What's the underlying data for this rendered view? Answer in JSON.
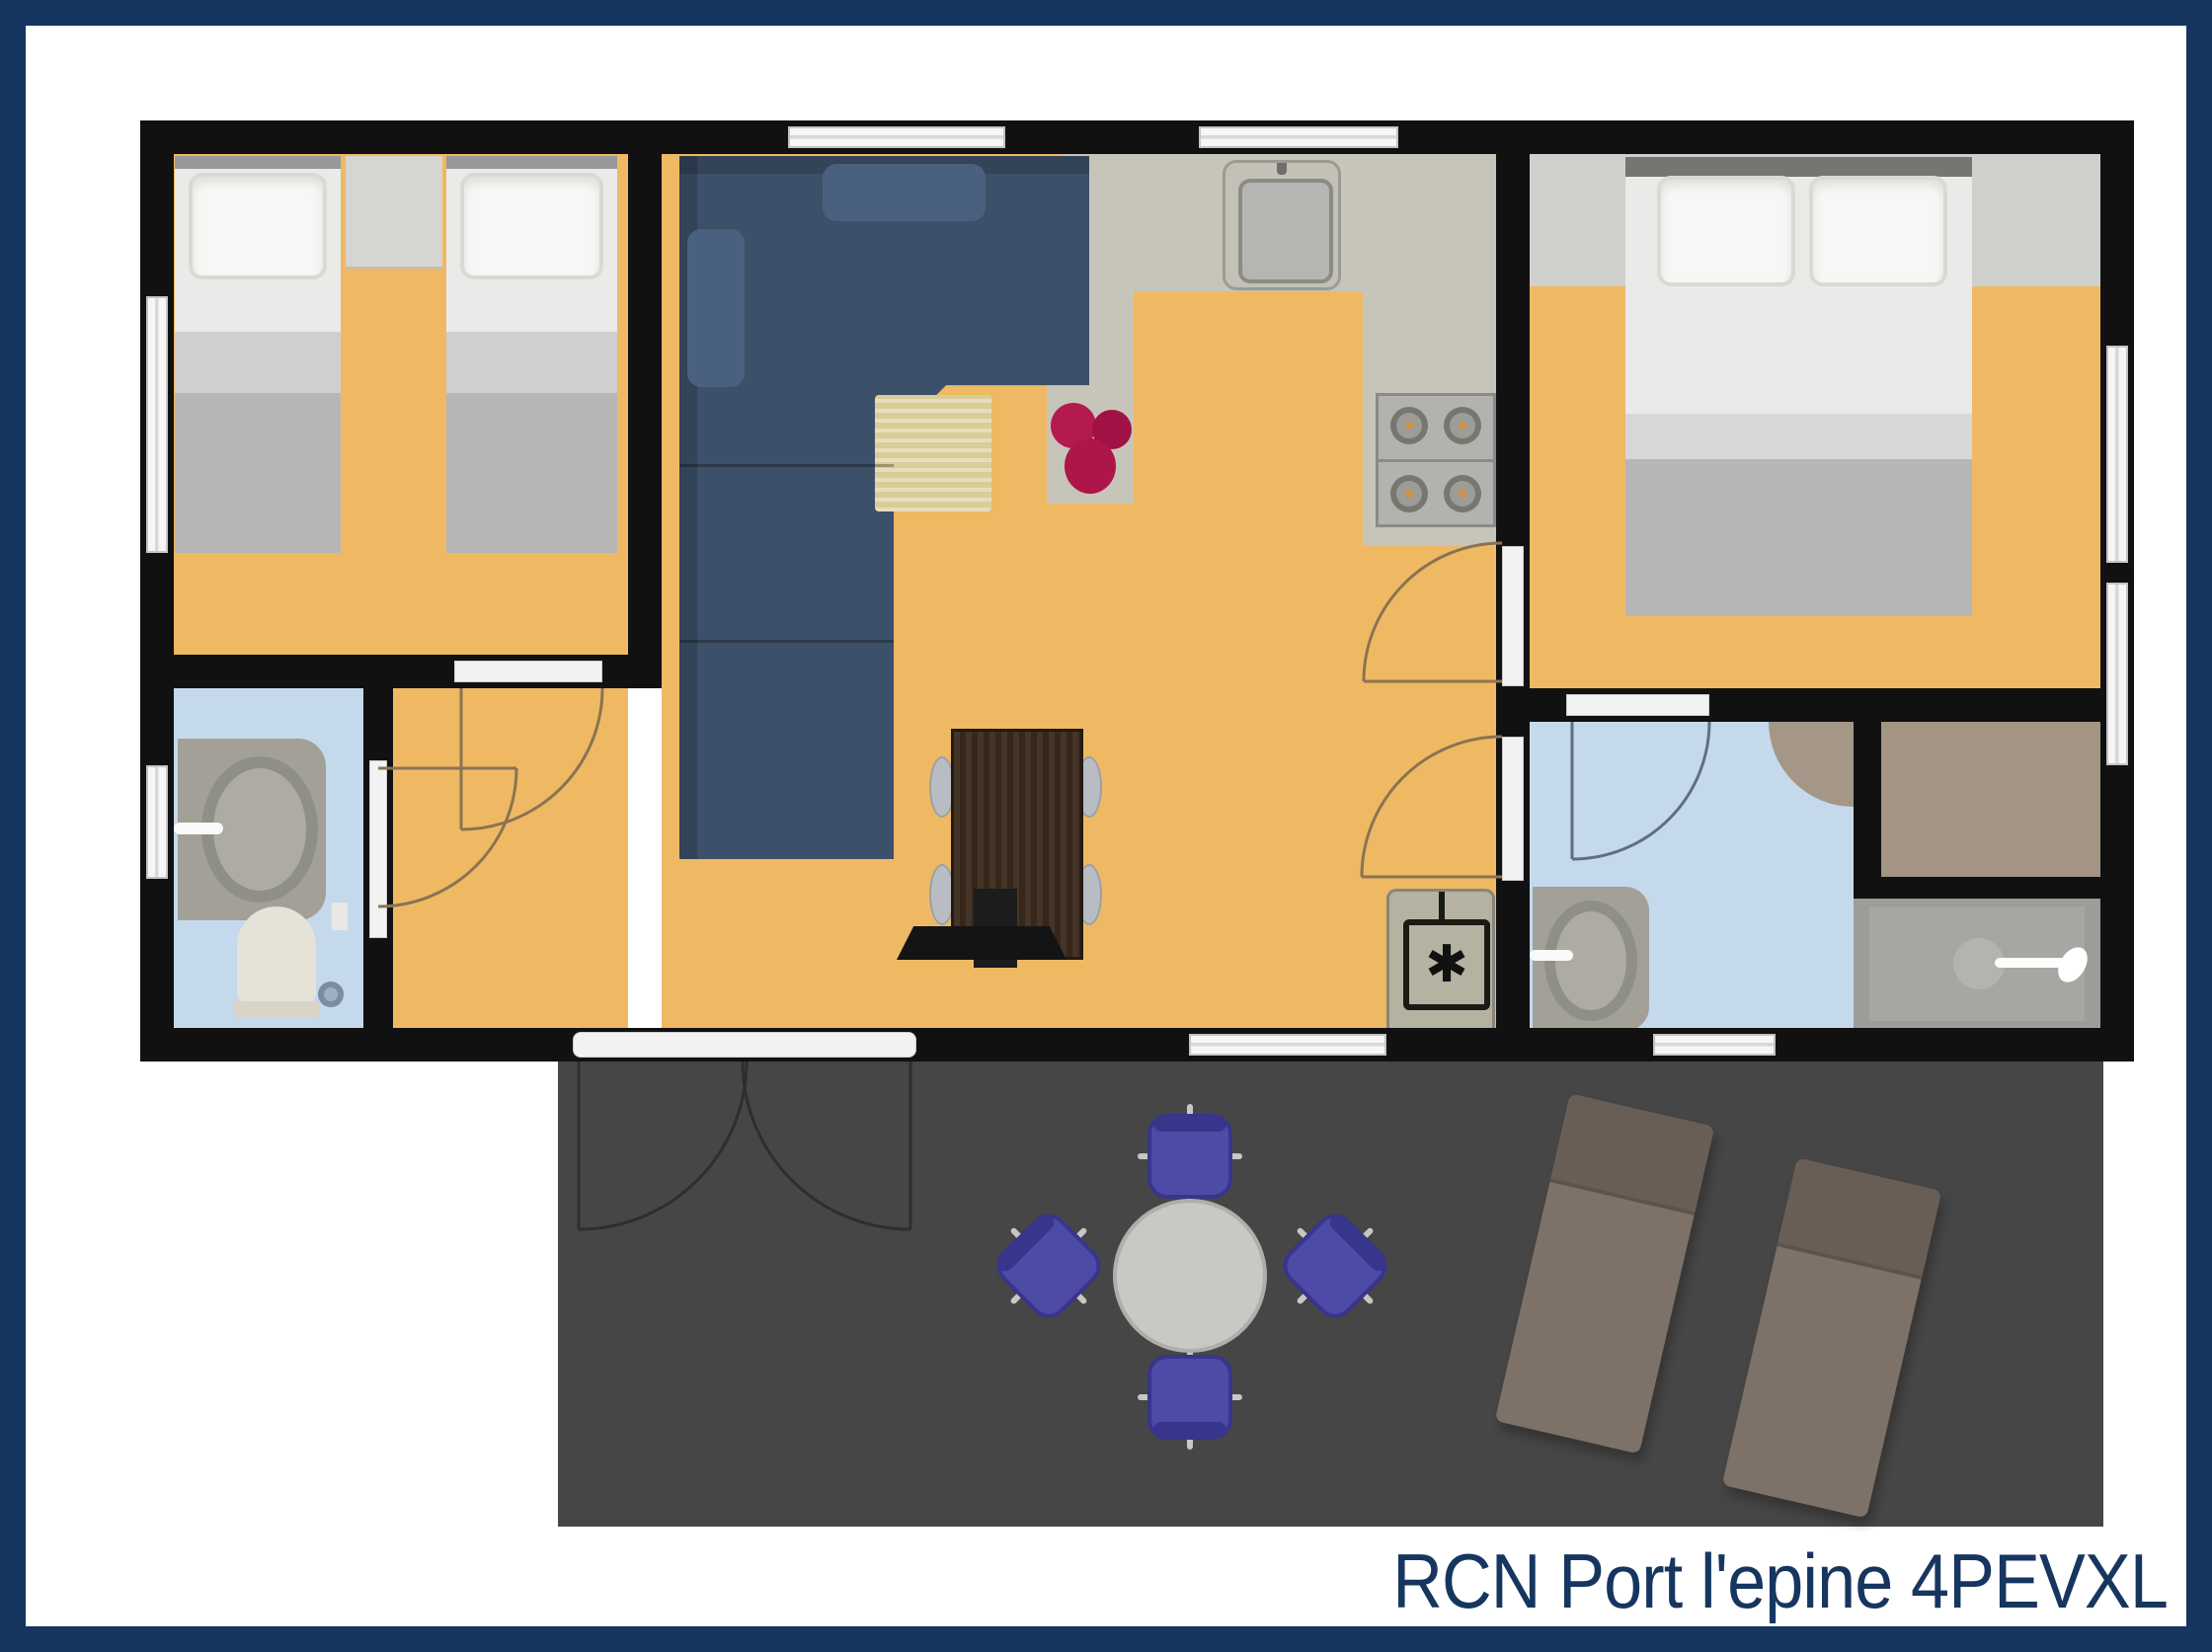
{
  "title": "RCN Port l'epine 4PEVXL",
  "boiler_symbol": "✱",
  "colors": {
    "frame-navy": "#16365f",
    "wall-black": "#111111",
    "floor-orange": "#efb964",
    "kitchen-gray": "#c7c4ba",
    "bathroom-blue": "#c5d9ec",
    "terrace-gray": "#464646",
    "sofa-blue": "#3d5069",
    "rug-beige": "#d9cd97",
    "flower-magenta": "#ae1549",
    "table-brown": "#3a2a1c",
    "chair-purple": "#4d4ba6",
    "lounger-taupe": "#7e7268",
    "bed-gray": "#b6b6b4",
    "closet-taupe": "#a39484",
    "window-white": "#f6f6f6",
    "shower-gray": "#9c9c98",
    "arc-brown": "#8a7353",
    "arc-blue": "#5f6f82"
  }
}
